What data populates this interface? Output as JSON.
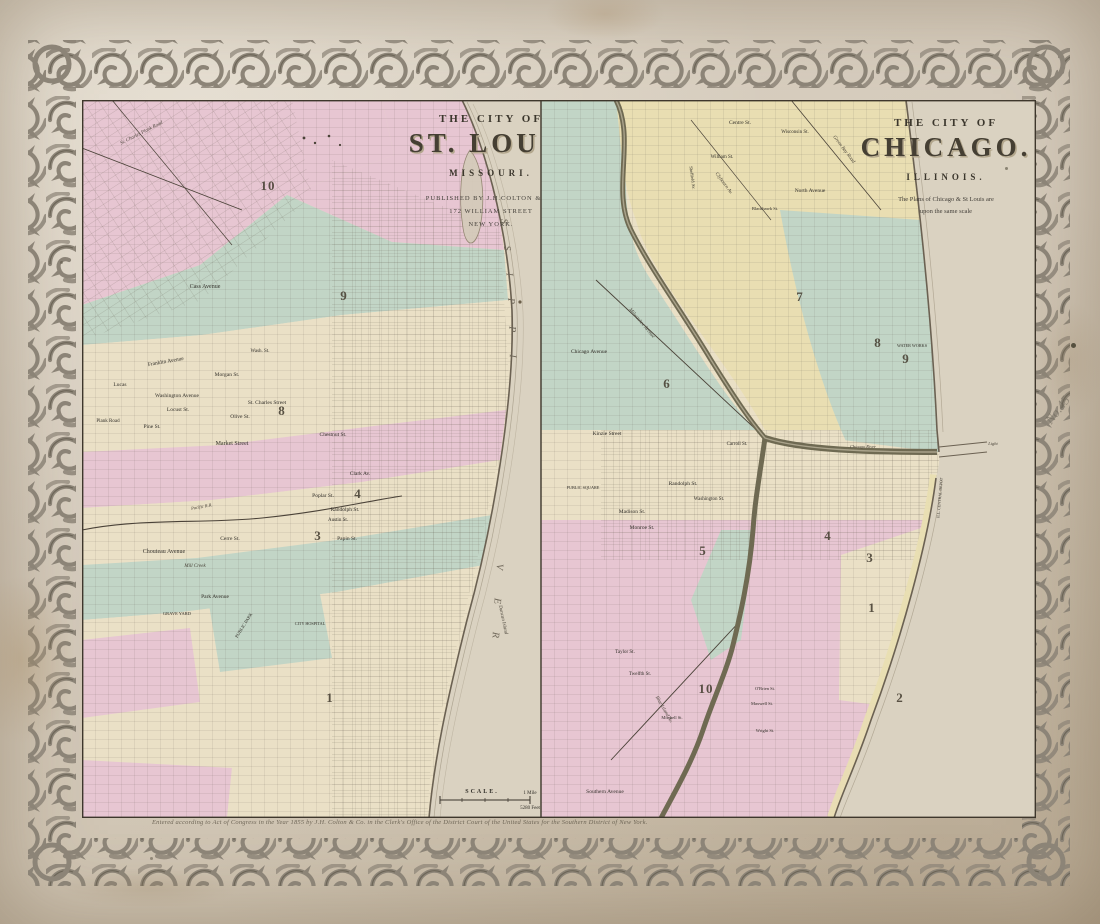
{
  "page": {
    "plate_number": "No.45",
    "copyright": "Entered according to Act of Congress in the Year 1855 by J.H. Colton & Co. in the Clerk's Office of the District Court of the United States for the Southern District of New York."
  },
  "palette": {
    "paper": "#d5cbbc",
    "map_cream": "#eae0c6",
    "district_pink": "#e7c6d2",
    "district_green": "#c2d5c6",
    "district_yellow": "#e9deb2",
    "water_paper": "#dad2c1",
    "ink": "#3e372c",
    "border_scroll": "#8c8477"
  },
  "stlouis": {
    "title_prefix": "THE CITY OF",
    "title": "ST. LOUIS",
    "state": "MISSOURI.",
    "publisher_line1": "PUBLISHED BY J.H.COLTON & Co.",
    "publisher_line2": "172 WILLIAM STREET",
    "publisher_line3": "NEW YORK.",
    "river_word1": "MISSISSIPPI",
    "river_word2": "RIVER",
    "scale": {
      "title": "SCALE.",
      "mile": "1 Mile",
      "feet": "5280 Feet"
    },
    "labels": [
      {
        "t": "St. Charles Plank Road",
        "x": 60,
        "y": 34,
        "r": -27,
        "s": 5,
        "cls": "ital"
      },
      {
        "t": "Cass Avenue",
        "x": 123,
        "y": 188,
        "s": 6
      },
      {
        "t": "Wash. St.",
        "x": 178,
        "y": 252,
        "s": 5
      },
      {
        "t": "Franklin Avenue",
        "x": 84,
        "y": 263,
        "r": -10,
        "s": 5.5
      },
      {
        "t": "Morgan St.",
        "x": 145,
        "y": 276,
        "s": 5.5
      },
      {
        "t": "Lucas",
        "x": 38,
        "y": 286,
        "s": 5.5
      },
      {
        "t": "Washington Avenue",
        "x": 95,
        "y": 297,
        "s": 5.5
      },
      {
        "t": "St. Charles Street",
        "x": 185,
        "y": 304,
        "s": 5.5
      },
      {
        "t": "Locust St.",
        "x": 96,
        "y": 311,
        "s": 5.5
      },
      {
        "t": "Olive St.",
        "x": 158,
        "y": 318,
        "s": 5.5
      },
      {
        "t": "Pine St.",
        "x": 70,
        "y": 328,
        "s": 5.5
      },
      {
        "t": "Chestnut St.",
        "x": 251,
        "y": 336,
        "s": 5.5
      },
      {
        "t": "Market Street",
        "x": 150,
        "y": 345,
        "s": 6
      },
      {
        "t": "Clark Av.",
        "x": 278,
        "y": 375,
        "s": 5.5
      },
      {
        "t": "Poplar St.",
        "x": 241,
        "y": 397,
        "s": 5.5
      },
      {
        "t": "Pacific R.R.",
        "x": 120,
        "y": 408,
        "r": -10,
        "s": 4.5,
        "cls": "ital"
      },
      {
        "t": "Randolph St.",
        "x": 263,
        "y": 411,
        "s": 5.5
      },
      {
        "t": "Austin St.",
        "x": 256,
        "y": 421,
        "s": 5
      },
      {
        "t": "Plank Road",
        "x": 26,
        "y": 322,
        "s": 5
      },
      {
        "t": "Cerre St.",
        "x": 148,
        "y": 440,
        "s": 5.5
      },
      {
        "t": "Papin St.",
        "x": 265,
        "y": 440,
        "s": 5.5
      },
      {
        "t": "Chouteau Avenue",
        "x": 82,
        "y": 453,
        "s": 6
      },
      {
        "t": "Mill Creek",
        "x": 113,
        "y": 467,
        "s": 5,
        "cls": "ital"
      },
      {
        "t": "Park Avenue",
        "x": 133,
        "y": 498,
        "s": 5.5
      },
      {
        "t": "GRAVE YARD",
        "x": 95,
        "y": 515,
        "s": 4.5
      },
      {
        "t": "PUBLIC PARK",
        "x": 163,
        "y": 526,
        "r": -58,
        "s": 4.5
      },
      {
        "t": "CITY HOSPITAL",
        "x": 228,
        "y": 525,
        "s": 4.2
      },
      {
        "t": "Duncan Island",
        "x": 420,
        "y": 520,
        "r": 78,
        "s": 5,
        "cls": "ital water2"
      }
    ],
    "wards": [
      {
        "t": "10",
        "x": 186,
        "y": 90,
        "cls": "ward"
      },
      {
        "t": "9",
        "x": 262,
        "y": 200,
        "cls": "ward"
      },
      {
        "t": "8",
        "x": 200,
        "y": 315,
        "cls": "ward"
      },
      {
        "t": "4",
        "x": 276,
        "y": 398,
        "cls": "ward"
      },
      {
        "t": "3",
        "x": 236,
        "y": 440,
        "cls": "ward"
      },
      {
        "t": "1",
        "x": 248,
        "y": 602,
        "cls": "ward"
      }
    ]
  },
  "chicago": {
    "title_prefix": "THE CITY OF",
    "title": "CHICAGO.",
    "state": "ILLINOIS.",
    "note_line1": "The Plans of Chicago & St Louis are",
    "note_line2": "upon the same scale",
    "lake_word1": "LAKE",
    "lake_word2": "MICHIGAN",
    "labels": [
      {
        "t": "Centre St.",
        "x": 199,
        "y": 24,
        "s": 5.5
      },
      {
        "t": "Wisconsin St.",
        "x": 254,
        "y": 33,
        "s": 5
      },
      {
        "t": "Green Bay Road",
        "x": 302,
        "y": 50,
        "r": 53,
        "s": 5,
        "cls": "ital"
      },
      {
        "t": "William St.",
        "x": 181,
        "y": 58,
        "s": 5
      },
      {
        "t": "Sheffield Av.",
        "x": 150,
        "y": 78,
        "r": 82,
        "s": 4.5
      },
      {
        "t": "Clybourn Av.",
        "x": 182,
        "y": 84,
        "r": 53,
        "s": 5,
        "cls": "ital"
      },
      {
        "t": "North Avenue",
        "x": 269,
        "y": 92,
        "s": 5.5
      },
      {
        "t": "Blackhawk St.",
        "x": 224,
        "y": 110,
        "s": 4.5
      },
      {
        "t": "Milwaukee Avenue",
        "x": 100,
        "y": 224,
        "r": 50,
        "s": 5,
        "cls": "ital"
      },
      {
        "t": "WATER WORKS",
        "x": 371,
        "y": 247,
        "s": 4.2
      },
      {
        "t": "Chicago Avenue",
        "x": 48,
        "y": 253,
        "s": 5.5
      },
      {
        "t": "Kinzie Street",
        "x": 66,
        "y": 335,
        "s": 5.5
      },
      {
        "t": "Carroll St.",
        "x": 196,
        "y": 345,
        "s": 5
      },
      {
        "t": "Chicago River",
        "x": 322,
        "y": 348,
        "s": 4.5,
        "cls": "ital"
      },
      {
        "t": "Light",
        "x": 452,
        "y": 345,
        "s": 4.5,
        "cls": "ital"
      },
      {
        "t": "Randolph St.",
        "x": 142,
        "y": 385,
        "s": 5.5
      },
      {
        "t": "PUBLIC SQUARE",
        "x": 42,
        "y": 389,
        "s": 4.2
      },
      {
        "t": "Washington St.",
        "x": 168,
        "y": 400,
        "s": 5
      },
      {
        "t": "ILL. CENTRAL DEPOT",
        "x": 400,
        "y": 398,
        "r": -85,
        "s": 4
      },
      {
        "t": "Madison St.",
        "x": 91,
        "y": 413,
        "s": 5.5
      },
      {
        "t": "Monroe St.",
        "x": 101,
        "y": 429,
        "s": 5.5
      },
      {
        "t": "Taylor St.",
        "x": 84,
        "y": 553,
        "s": 5
      },
      {
        "t": "Twelfth St.",
        "x": 99,
        "y": 575,
        "s": 5
      },
      {
        "t": "O'Brien St.",
        "x": 224,
        "y": 590,
        "s": 4.5
      },
      {
        "t": "Maxwell St.",
        "x": 221,
        "y": 605,
        "s": 4.5
      },
      {
        "t": "Blue Island Av.",
        "x": 122,
        "y": 610,
        "r": 60,
        "s": 5,
        "cls": "ital"
      },
      {
        "t": "Mitchell St.",
        "x": 131,
        "y": 619,
        "s": 4.5
      },
      {
        "t": "Wright St.",
        "x": 224,
        "y": 632,
        "s": 4.5
      },
      {
        "t": "Southern Avenue",
        "x": 64,
        "y": 693,
        "s": 5.5
      }
    ],
    "wards": [
      {
        "t": "7",
        "x": 259,
        "y": 201,
        "cls": "ward"
      },
      {
        "t": "8",
        "x": 337,
        "y": 247,
        "cls": "ward"
      },
      {
        "t": "9",
        "x": 365,
        "y": 263,
        "cls": "ward"
      },
      {
        "t": "6",
        "x": 126,
        "y": 288,
        "cls": "ward"
      },
      {
        "t": "3",
        "x": 329,
        "y": 462,
        "cls": "ward"
      },
      {
        "t": "5",
        "x": 162,
        "y": 455,
        "cls": "ward"
      },
      {
        "t": "4",
        "x": 287,
        "y": 440,
        "cls": "ward"
      },
      {
        "t": "1",
        "x": 331,
        "y": 512,
        "cls": "ward"
      },
      {
        "t": "10",
        "x": 165,
        "y": 593,
        "cls": "ward"
      },
      {
        "t": "2",
        "x": 359,
        "y": 602,
        "cls": "ward"
      }
    ]
  }
}
